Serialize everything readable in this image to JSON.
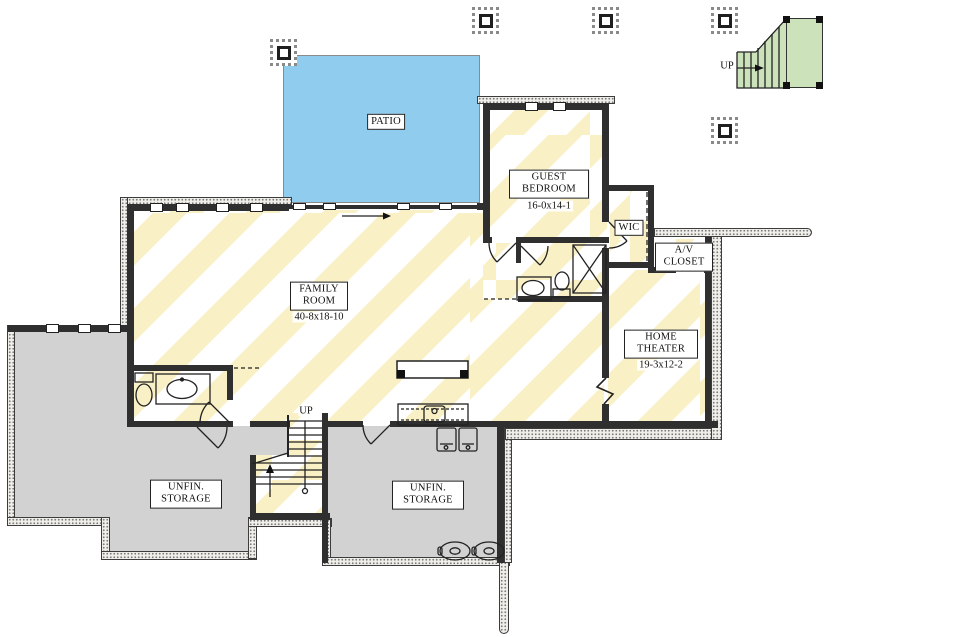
{
  "plan_type": "basement-floor-plan",
  "colors": {
    "patio_blue": "#8fccee",
    "floor_stripe_yellow": "#faf0c6",
    "storage_gray": "#d2d2d2",
    "exterior_stair_green": "#cbe2bb",
    "wall_dark": "#2f2f2f"
  },
  "rooms": {
    "patio": {
      "label": "PATIO"
    },
    "family_room": {
      "label": "FAMILY ROOM",
      "dims": "40-8x18-10"
    },
    "guest_bedroom": {
      "label": "GUEST BEDROOM",
      "dims": "16-0x14-1"
    },
    "wic": {
      "label": "WIC"
    },
    "av_closet": {
      "label": "A/V CLOSET"
    },
    "home_theater": {
      "label": "HOME THEATER",
      "dims": "19-3x12-2"
    },
    "storage_left": {
      "label": "UNFIN. STORAGE"
    },
    "storage_center": {
      "label": "UNFIN. STORAGE"
    }
  },
  "stairs": {
    "interior_up": "UP",
    "exterior_up": "UP"
  }
}
